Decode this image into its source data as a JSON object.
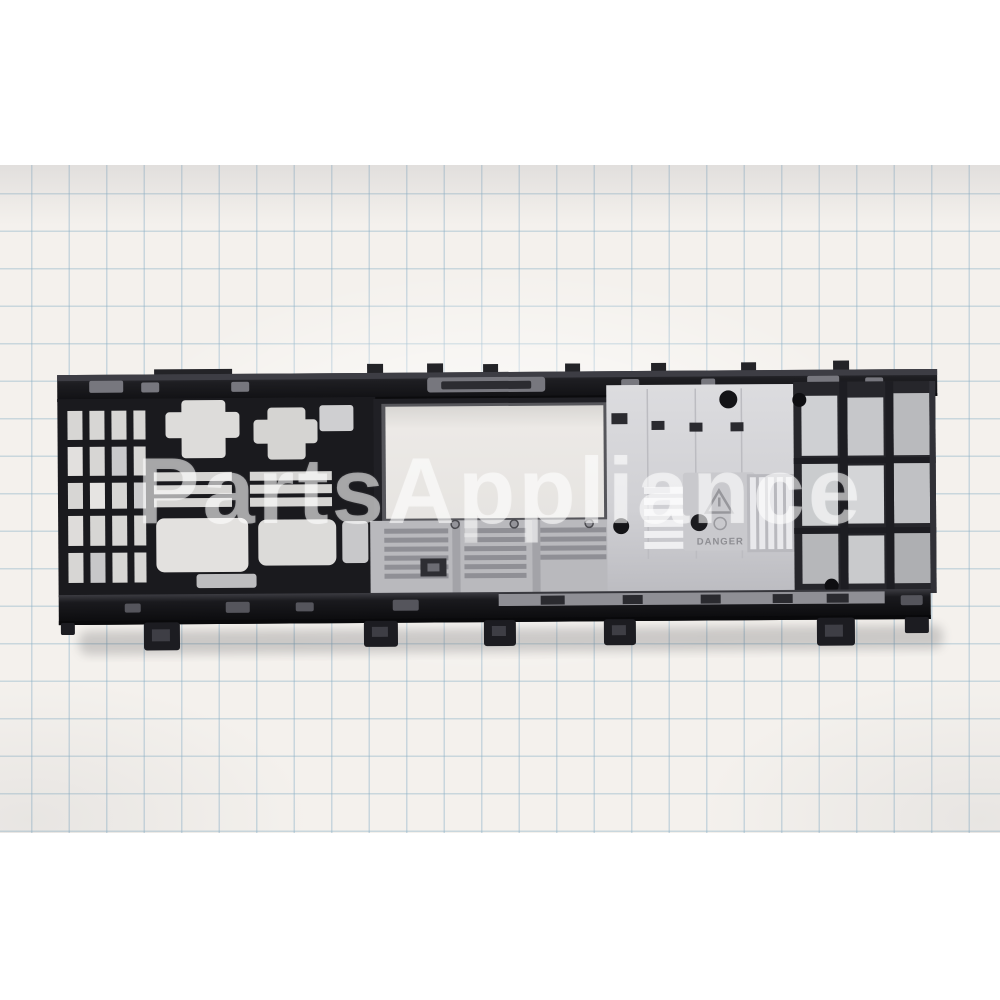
{
  "photo": {
    "description": "Product photograph of a long black plastic appliance control-panel rear frame lying on blue grid paper, letterboxed top and bottom with white.",
    "background": {
      "canvas_color": "#ffffff",
      "paper_color": "#f4f1ed",
      "grid_line_color": "#8aafc6",
      "grid_size_px": 37.5
    },
    "watermark": {
      "text": "PartsAppliance",
      "color": "#ffffff"
    },
    "part": {
      "name": "control panel rear mounting frame",
      "material_colors": {
        "plastic_black": "#1a1a1d",
        "metallic_silver": "#d2d2d5",
        "opening_light": "#e9e7e4"
      },
      "danger_label": {
        "text": "DANGER",
        "icon": "warning-triangle-icon",
        "text_color": "#8e8e93"
      }
    }
  }
}
